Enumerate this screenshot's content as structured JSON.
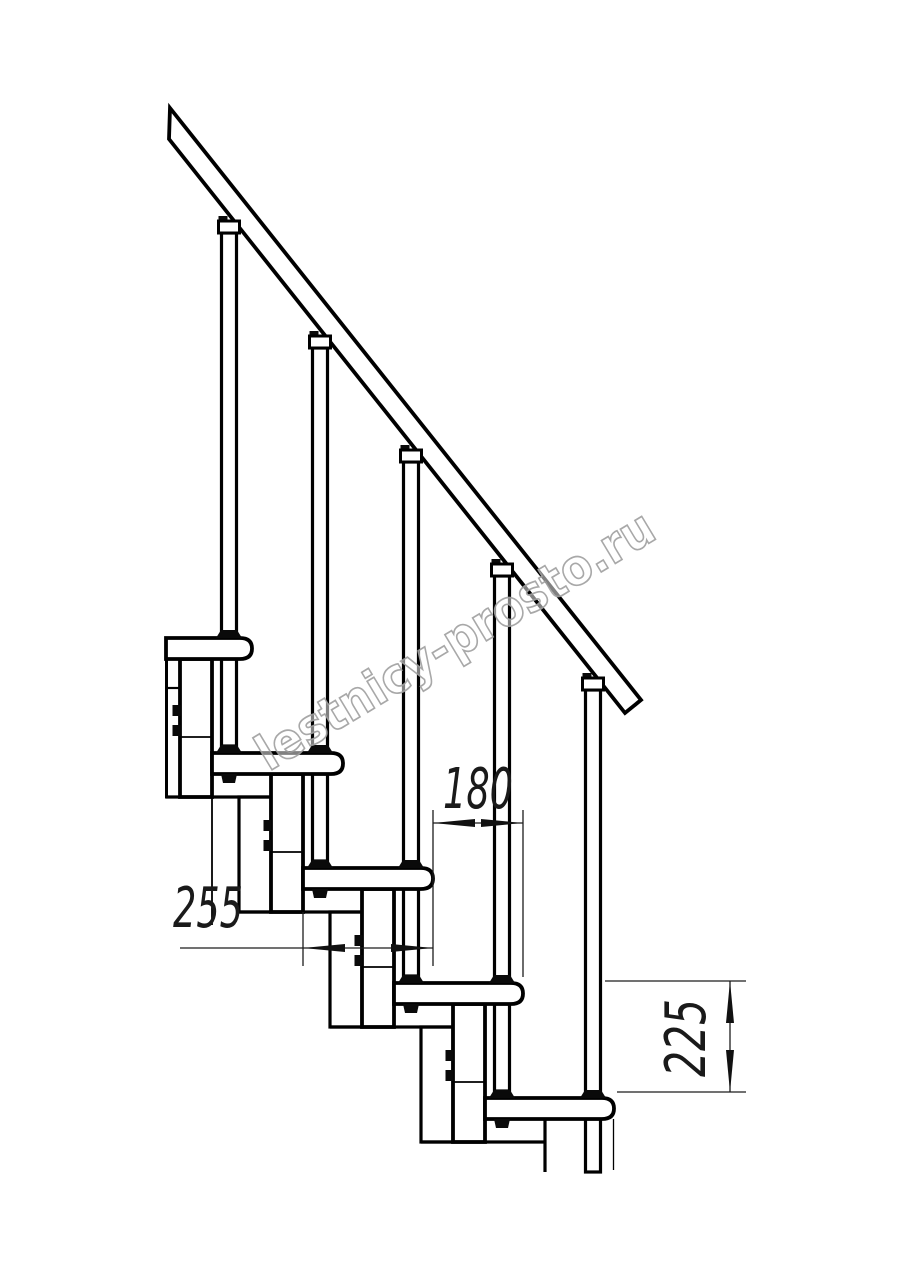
{
  "drawing": {
    "watermark_text": "lestnicy-prosto.ru",
    "dimensions": [
      {
        "id": "tread-depth",
        "label": "255",
        "orientation": "horizontal"
      },
      {
        "id": "step-offset",
        "label": "180",
        "orientation": "horizontal"
      },
      {
        "id": "step-rise",
        "label": "225",
        "orientation": "vertical"
      }
    ],
    "colors": {
      "ink": "#000000",
      "dim_line": "#1c1c1c",
      "watermark_stroke": "#9e9e9e",
      "background": "#ffffff"
    }
  }
}
